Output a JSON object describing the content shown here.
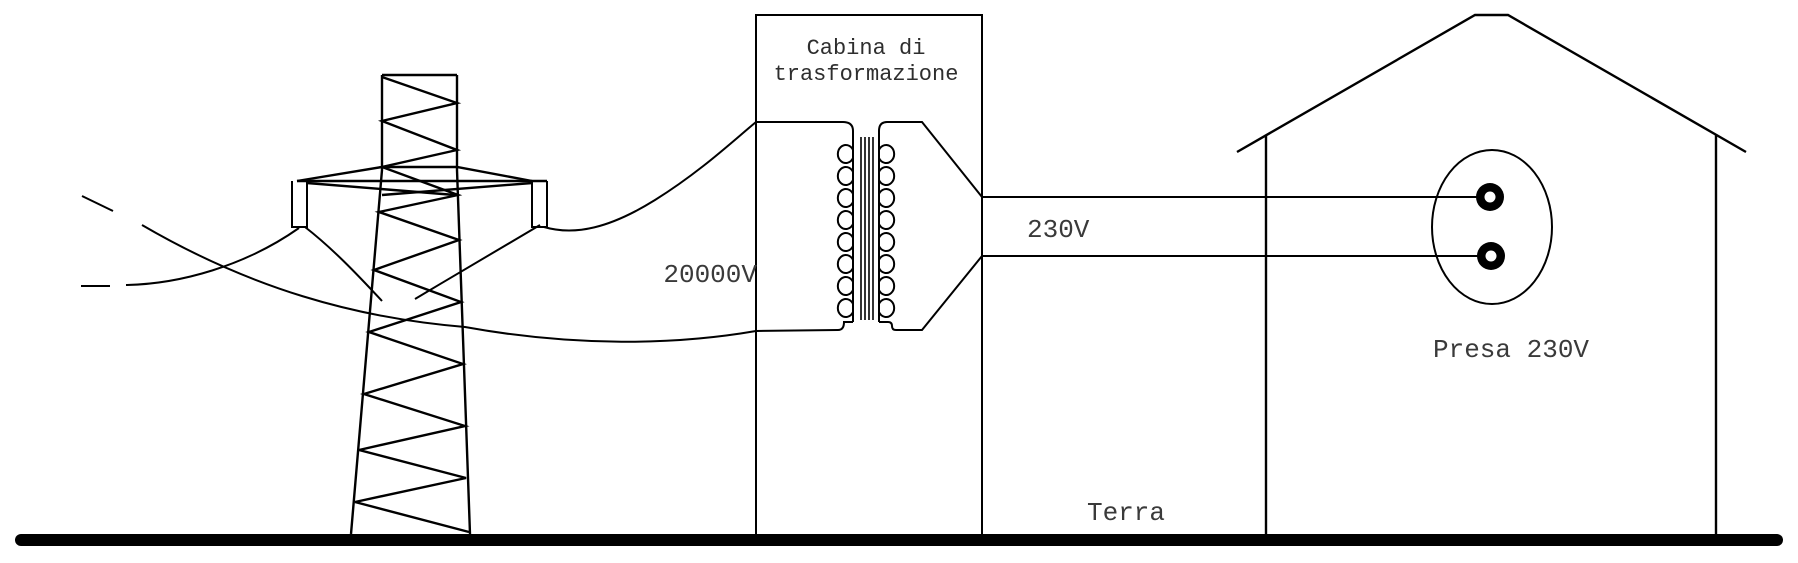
{
  "diagram": {
    "cabin": {
      "title_line1": "Cabina di",
      "title_line2": "trasformazione"
    },
    "labels": {
      "primary_voltage": "20000V",
      "secondary_voltage": "230V",
      "socket": "Presa 230V",
      "ground": "Terra"
    },
    "components": [
      "transmission-tower",
      "high-voltage-lines",
      "transformer",
      "transformer-cabin",
      "house",
      "power-socket",
      "ground-line"
    ]
  },
  "colors": {
    "line": "#000000",
    "text": "#3a3a3a",
    "background": "#ffffff"
  }
}
